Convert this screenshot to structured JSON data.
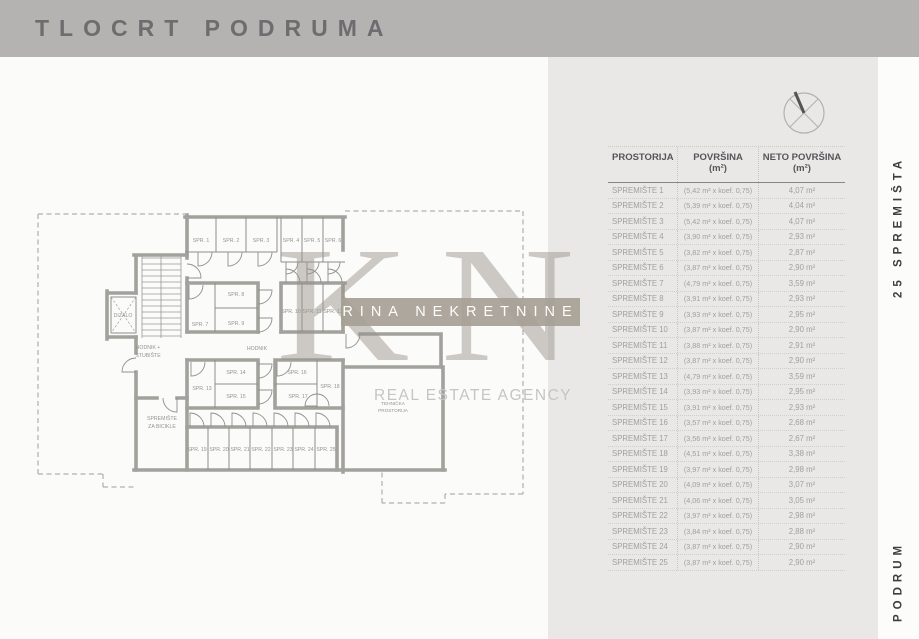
{
  "title": "TLOCRT PODRUMA",
  "side_labels": {
    "top": "25 SPREMIŠTA",
    "bottom": "PODRUM"
  },
  "watermark": {
    "monogram": "KN",
    "agency_name": "RINA NEKRETNINE",
    "tagline": "REAL ESTATE AGENCY"
  },
  "icons": {
    "compass": "compass-rose"
  },
  "colors": {
    "header_band": "#b4b3b1",
    "panel": "#e9e8e6",
    "wall": "#a2a19b",
    "watermark_band": "#a79f95"
  },
  "table": {
    "columns": [
      {
        "label": "PROSTORIJA",
        "sub": ""
      },
      {
        "label": "POVRŠINA",
        "sub": "(m²)"
      },
      {
        "label": "NETO POVRŠINA",
        "sub": "(m²)"
      }
    ],
    "rows": [
      {
        "name": "SPREMIŠTE 1",
        "gross": "(5,42 m² x koef. 0,75)",
        "net": "4,07 m²"
      },
      {
        "name": "SPREMIŠTE 2",
        "gross": "(5,39 m² x koef. 0,75)",
        "net": "4,04 m²"
      },
      {
        "name": "SPREMIŠTE 3",
        "gross": "(5,42 m² x koef. 0,75)",
        "net": "4,07 m²"
      },
      {
        "name": "SPREMIŠTE 4",
        "gross": "(3,90 m² x koef. 0,75)",
        "net": "2,93 m²"
      },
      {
        "name": "SPREMIŠTE 5",
        "gross": "(3,82 m² x koef. 0,75)",
        "net": "2,87 m²"
      },
      {
        "name": "SPREMIŠTE 6",
        "gross": "(3,87 m² x koef. 0,75)",
        "net": "2,90 m²"
      },
      {
        "name": "SPREMIŠTE 7",
        "gross": "(4,79 m² x koef. 0,75)",
        "net": "3,59 m²"
      },
      {
        "name": "SPREMIŠTE 8",
        "gross": "(3,91 m² x koef. 0,75)",
        "net": "2,93 m²"
      },
      {
        "name": "SPREMIŠTE 9",
        "gross": "(3,93 m² x koef. 0,75)",
        "net": "2,95 m²"
      },
      {
        "name": "SPREMIŠTE 10",
        "gross": "(3,87 m² x koef. 0,75)",
        "net": "2,90 m²"
      },
      {
        "name": "SPREMIŠTE 11",
        "gross": "(3,88 m² x koef. 0,75)",
        "net": "2,91 m²"
      },
      {
        "name": "SPREMIŠTE 12",
        "gross": "(3,87 m² x koef. 0,75)",
        "net": "2,90 m²"
      },
      {
        "name": "SPREMIŠTE 13",
        "gross": "(4,79 m² x koef. 0,75)",
        "net": "3,59 m²"
      },
      {
        "name": "SPREMIŠTE 14",
        "gross": "(3,93 m² x koef. 0,75)",
        "net": "2,95 m²"
      },
      {
        "name": "SPREMIŠTE 15",
        "gross": "(3,91 m² x koef. 0,75)",
        "net": "2,93 m²"
      },
      {
        "name": "SPREMIŠTE 16",
        "gross": "(3,57 m² x koef. 0,75)",
        "net": "2,68 m²"
      },
      {
        "name": "SPREMIŠTE 17",
        "gross": "(3,56 m² x koef. 0,75)",
        "net": "2,67 m²"
      },
      {
        "name": "SPREMIŠTE 18",
        "gross": "(4,51 m² x koef. 0,75)",
        "net": "3,38 m²"
      },
      {
        "name": "SPREMIŠTE 19",
        "gross": "(3,97 m² x koef. 0,75)",
        "net": "2,98 m²"
      },
      {
        "name": "SPREMIŠTE 20",
        "gross": "(4,09 m² x koef. 0,75)",
        "net": "3,07 m²"
      },
      {
        "name": "SPREMIŠTE 21",
        "gross": "(4,06 m² x koef. 0,75)",
        "net": "3,05 m²"
      },
      {
        "name": "SPREMIŠTE 22",
        "gross": "(3,97 m² x koef. 0,75)",
        "net": "2,98 m²"
      },
      {
        "name": "SPREMIŠTE 23",
        "gross": "(3,84 m² x koef. 0,75)",
        "net": "2,88 m²"
      },
      {
        "name": "SPREMIŠTE 24",
        "gross": "(3,87 m² x koef. 0,75)",
        "net": "2,90 m²"
      },
      {
        "name": "SPREMIŠTE 25",
        "gross": "(3,87 m² x koef. 0,75)",
        "net": "2,90 m²"
      }
    ]
  },
  "floorplan": {
    "rooms": [
      "SPR. 1",
      "SPR. 2",
      "SPR. 3",
      "SPR. 4",
      "SPR. 5",
      "SPR. 6",
      "SPR. 7",
      "SPR. 8",
      "SPR. 9",
      "SPR. 10",
      "SPR. 11",
      "SPR. 12",
      "SPR. 13",
      "SPR. 14",
      "SPR. 15",
      "SPR. 16",
      "SPR. 17",
      "SPR. 18",
      "SPR. 19",
      "SPR. 20",
      "SPR. 21",
      "SPR. 22",
      "SPR. 23",
      "SPR. 24",
      "SPR. 25"
    ],
    "elevator": "DIZALO",
    "corridor": "HODNIK",
    "corridor_stairs_l1": "HODNIK +",
    "corridor_stairs_l2": "STUBIŠTE",
    "bike_l1": "SPREMIŠTE",
    "bike_l2": "ZA BICIKLE",
    "tech_l1": "TEHNIČKA",
    "tech_l2": "PROSTORIJA"
  }
}
